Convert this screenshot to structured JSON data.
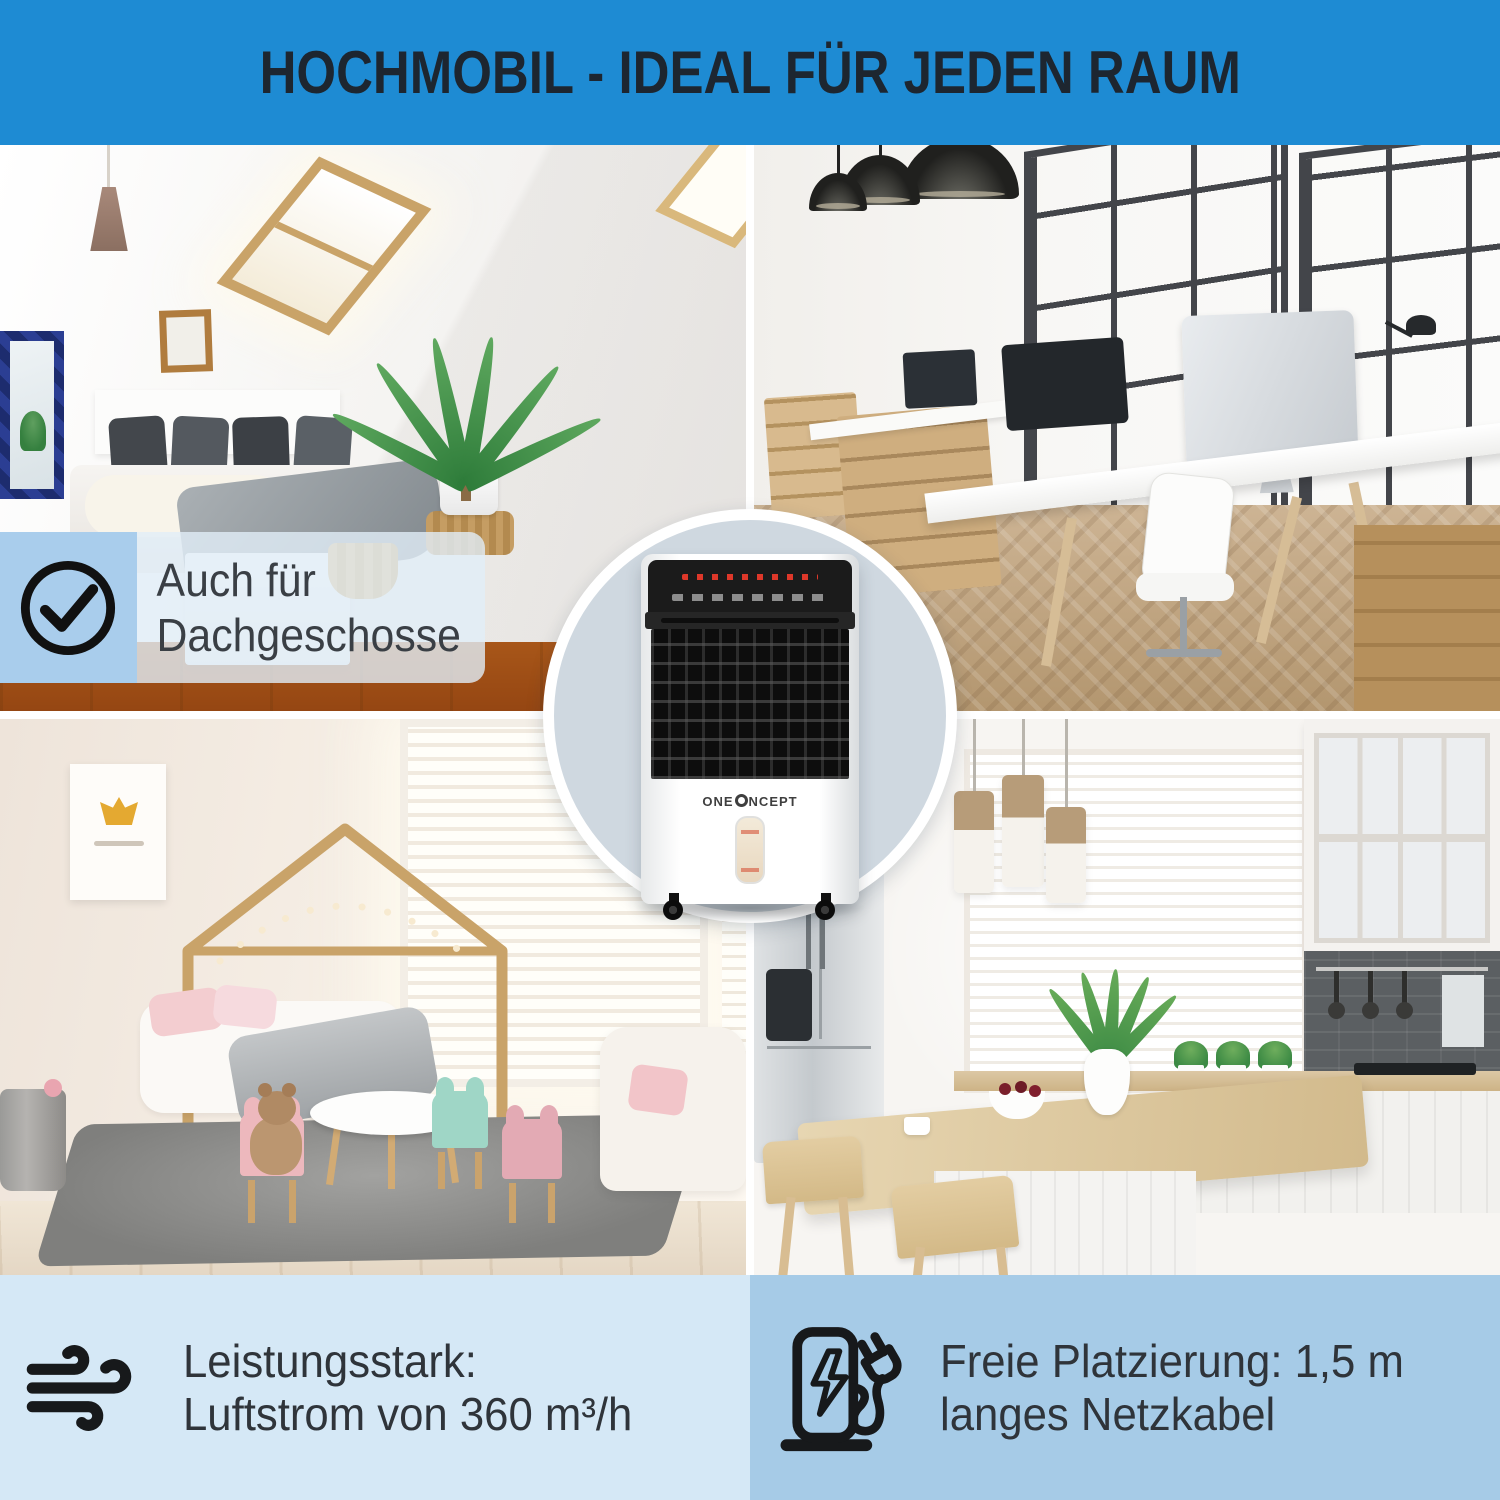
{
  "header": {
    "title": "HOCHMOBIL - IDEAL FÜR JEDEN RAUM"
  },
  "badge": {
    "icon": "check-circle-icon",
    "line1": "Auch für",
    "line2": "Dachgeschosse"
  },
  "center": {
    "product": "mobile-air-cooler",
    "product_brand_part1": "ONE",
    "product_brand_part2": "NCEPT"
  },
  "photos": {
    "top_left": "attic-bedroom",
    "top_right": "open-plan-office",
    "bottom_left": "kids-room",
    "bottom_right": "kitchen"
  },
  "features": [
    {
      "icon": "wind-icon",
      "line1": "Leistungsstark:",
      "line2": "Luftstrom von 360 m³/h"
    },
    {
      "icon": "charging-cable-icon",
      "line1": "Freie Platzierung: 1,5 m",
      "line2": "langes Netzkabel"
    }
  ],
  "colors": {
    "header_blue": "#1e8bd3",
    "title_dark": "#1d2630",
    "band_light_blue": "#d5e8f6",
    "band_medium_blue": "#a6cbe7",
    "badge_square_blue": "#a9cdec",
    "circle_fill": "#cfd8e0",
    "text_dark": "#2f343a"
  }
}
